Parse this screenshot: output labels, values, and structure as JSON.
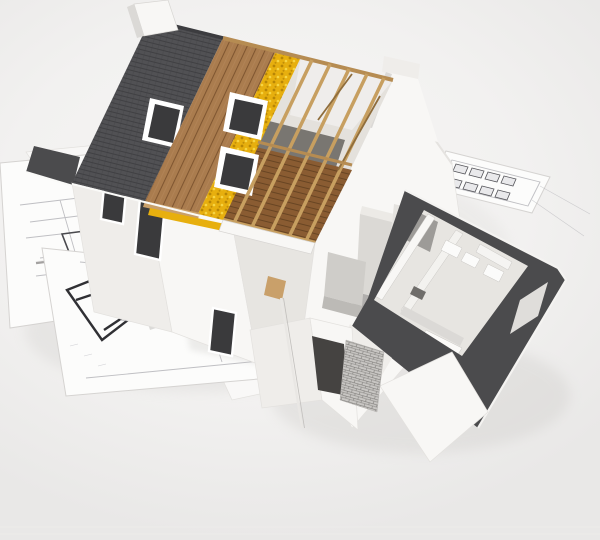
{
  "scene": {
    "description": "3D architectural rendering of a partially built house cutaway model standing on blueprint floor plans",
    "type": "natural-image-3d-render",
    "background": "#f2f1f0"
  },
  "colors": {
    "background": "#f2f1f0",
    "bg_edge": "#e9e8e7",
    "roof_tiles": "#515154",
    "tile_line": "#404043",
    "ridge_cap": "#3c3c3f",
    "sheathing": "#aa7c4e",
    "sheathing_line": "#7f5631",
    "insulation": "#e7af0e",
    "insulation_dot_dark": "#b88605",
    "insulation_dot_light": "#f6d544",
    "rafter": "#c79f60",
    "rafter_dark": "#8f6d3c",
    "purlin": "#b68c52",
    "attic_floor": "#8a5c32",
    "attic_floor_line": "#684523",
    "attic_interior": "#e4e1dc",
    "attic_shadow": "#55514d",
    "wall_bright": "#f8f7f5",
    "wall_light": "#efedea",
    "wall_medium": "#e7e5e1",
    "wall_shade": "#dbd9d6",
    "window": "#3a3a3c",
    "flat_roof": "#4b4b4d",
    "parapet": "#f4f3f1",
    "paper": "#fcfcfb",
    "bp_line": "#9a9aa0",
    "bp_bold": "#303034",
    "bp_gray": "#a5a3a1",
    "brick": "#c8c6c3",
    "brick_line": "#807e7b",
    "shadow": "#c8c6c3",
    "kitchen_light": "#dbd9d5",
    "kitchen_mid": "#cfcdc9",
    "kitchen_dark": "#bcbab6",
    "beam_end": "#c9a06a",
    "interior_dark": "#454341",
    "door_dark": "#6f6d6a",
    "fixture": "#fbfbfa"
  },
  "objects": [
    {
      "name": "main-house",
      "label": "Two-story house cutaway model"
    },
    {
      "name": "roof-tile-section",
      "label": "Dark grey tiled roof section with skylight"
    },
    {
      "name": "roof-sheathing-section",
      "label": "Wooden roof sheathing boards"
    },
    {
      "name": "roof-insulation-section",
      "label": "Yellow mineral wool insulation layer"
    },
    {
      "name": "roof-rafter-section",
      "label": "Exposed timber rafters over open attic"
    },
    {
      "name": "left-chimney",
      "label": "Chimney at ridge end"
    },
    {
      "name": "right-chimney",
      "label": "Chimney on right gable wall"
    },
    {
      "name": "skylight-windows",
      "label": "Roof skylight windows with white frames"
    },
    {
      "name": "facade-windows",
      "label": "Dark facade window openings with white frames"
    },
    {
      "name": "single-story-extension",
      "label": "Flat-roofed extension with rooms seen from above"
    },
    {
      "name": "bathroom-fixtures",
      "label": "Bathroom fixtures in extension"
    },
    {
      "name": "kitchen-units",
      "label": "Kitchen cabinets in the cutaway corner"
    },
    {
      "name": "brick-wall-patch",
      "label": "Unfinished brick wall section"
    },
    {
      "name": "blueprint-sheets",
      "label": "Architectural floor plan sheets under the model"
    },
    {
      "name": "downpipe",
      "label": "Gutter downpipe on gable wall"
    }
  ]
}
